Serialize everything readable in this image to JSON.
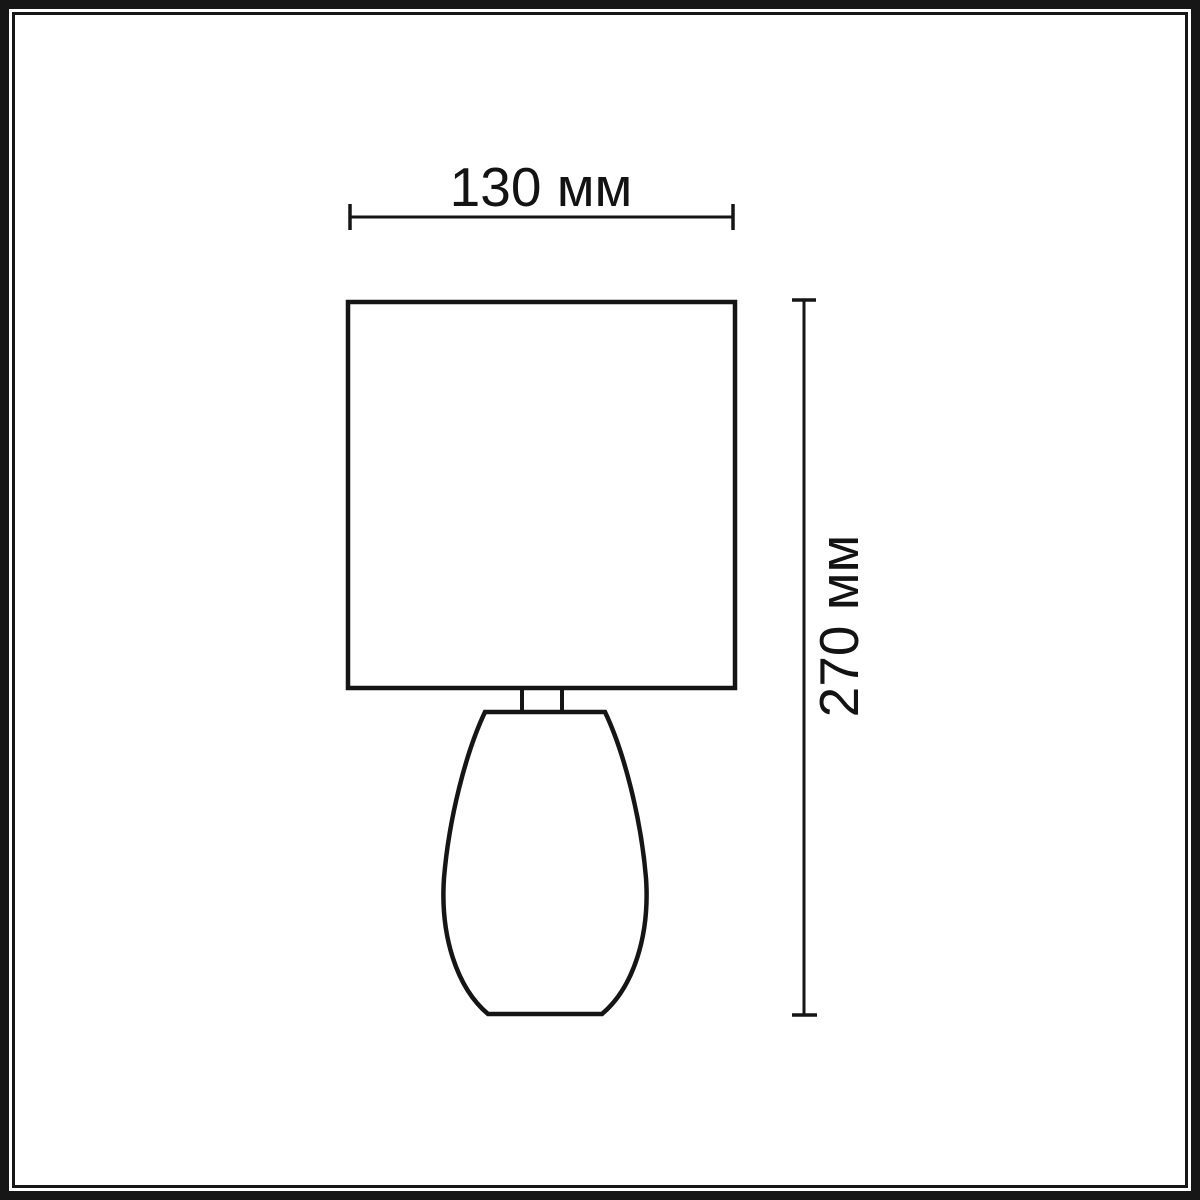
{
  "diagram": {
    "type": "product-dimension-drawing",
    "subject": "table lamp with square shade and teardrop base",
    "background_color": "#ffffff",
    "line_color": "#151515",
    "dimensions": {
      "width": {
        "label": "130 мм",
        "value_mm": 130,
        "applies_to": "shade width"
      },
      "height": {
        "label": "270 мм",
        "value_mm": 270,
        "applies_to": "total lamp height"
      }
    }
  }
}
